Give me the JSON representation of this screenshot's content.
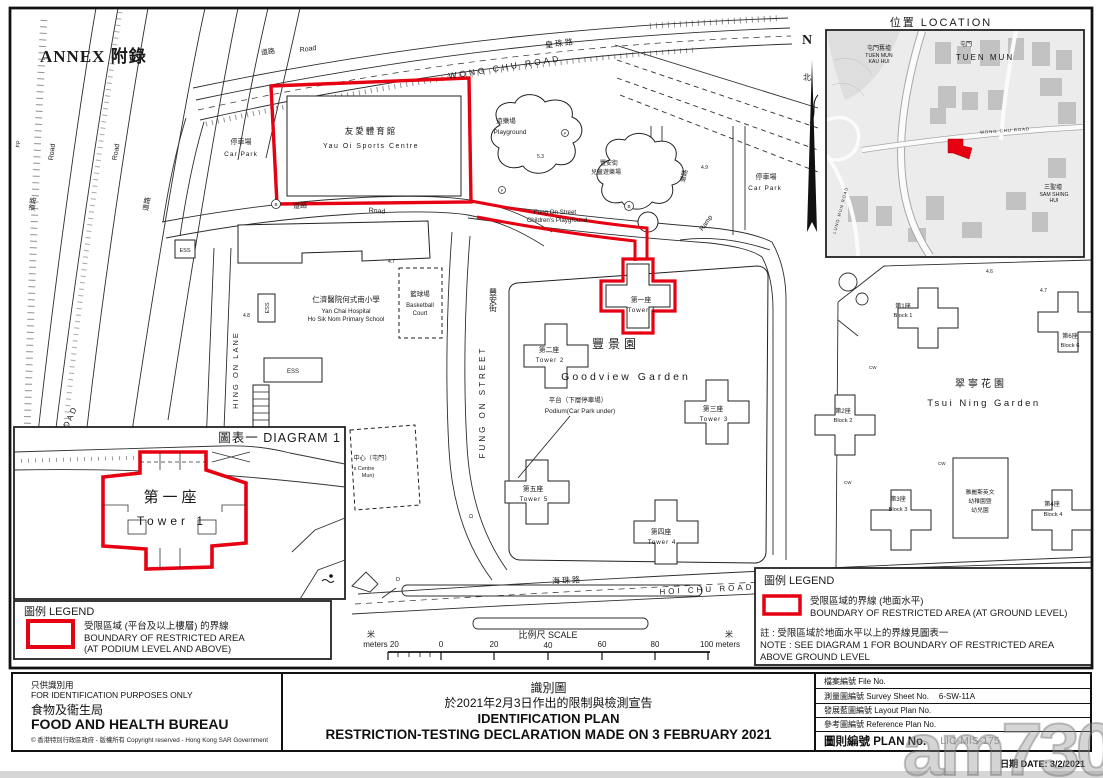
{
  "annex_label": "ANNEX 附錄",
  "watermark_text": "am730",
  "colors": {
    "boundary_red": "#e60012"
  },
  "north_arrow": {
    "n": "N",
    "zh": "北"
  },
  "location_inset": {
    "title": "位置  LOCATION",
    "tuen_mun_kau_hui_zh": "屯門舊墟",
    "tuen_mun_kau_hui_en1": "TUEN MUN",
    "tuen_mun_kau_hui_en2": "KAU HUI",
    "tuen_mun_zh": "屯門",
    "tuen_mun_en": "TUEN MUN",
    "sam_shing_hui_zh": "三聖墟",
    "sam_shing_hui_en1": "SAM SHING",
    "sam_shing_hui_en2": "HUI",
    "wong_chu_road": "WONG CHU ROAD",
    "lung_mun_road": "LUNG MUN ROAD"
  },
  "map": {
    "roads": {
      "wong_chu_zh": "皇珠路",
      "wong_chu_en": "WONG CHU ROAD",
      "hoi_chu_zh": "海珠路",
      "hoi_chu_en": "HOI CHU ROAD",
      "fung_on_zh": "豐安街",
      "fung_on_en": "FUNG ON STREET",
      "hing_on_en": "HING ON LANE",
      "hoi_wong_en": "HOI WONG ROAD",
      "road_zh": "道路",
      "road_en": "Road",
      "ramp": "Ramp"
    },
    "places": {
      "sports_centre_zh": "友愛體育館",
      "sports_centre_en": "Yau Oi Sports Centre",
      "car_park_zh": "停車場",
      "car_park_en": "Car Park",
      "playground_zh": "遊樂場",
      "playground_en": "Playground",
      "fos_pg_zh1": "豐安街",
      "fos_pg_zh2": "兒童遊樂場",
      "fos_pg_en1": "Fung On Street",
      "fos_pg_en2": "Children's Playground",
      "school_zh": "仁濟醫院何式南小學",
      "school_en1": "Yan Chai Hospital",
      "school_en2": "Ho Sik Nom Primary School",
      "basketball_zh": "籃球場",
      "basketball_en1": "Basketball",
      "basketball_en2": "Court",
      "goodview_zh": "豐景園",
      "goodview_en": "Goodview Garden",
      "podium_zh": "平台（下層停車場）",
      "podium_en": "Podium(Car Park under)",
      "tsui_ning_zh": "翠寧花園",
      "tsui_ning_en": "Tsui Ning Garden",
      "kg1": "雅麗斯英文",
      "kg2": "幼稚園暨",
      "kg3": "幼兒園",
      "centre_zh": "中心（屯門）",
      "centre_en1": "s Centre",
      "centre_en2": "Mun)"
    },
    "towers": {
      "t1_zh": "第一座",
      "t1_en": "Tower 1",
      "t2_zh": "第二座",
      "t2_en": "Tower 2",
      "t3_zh": "第三座",
      "t3_en": "Tower 3",
      "t4_zh": "第四座",
      "t4_en": "Tower 4",
      "t5_zh": "第五座",
      "t5_en": "Tower 5"
    },
    "blocks": {
      "b1_zh": "第1座",
      "b1_en": "Block 1",
      "b2_zh": "第2座",
      "b2_en": "Block 2",
      "b3_zh": "第3座",
      "b3_en": "Block 3",
      "b4_zh": "第4座",
      "b4_en": "Block 4",
      "b6_zh": "第6座",
      "b6_en": "Block 6"
    },
    "marks": {
      "cw": "CW",
      "d": "D",
      "b": "B",
      "p": "P",
      "fp": "FP",
      "ess": "ESS"
    },
    "spot_heights": [
      "4.7",
      "4.8",
      "4.9",
      "4.6",
      "4.7",
      "5.3"
    ]
  },
  "diagram1": {
    "title": "圖表一 DIAGRAM 1",
    "tower_zh": "第一座",
    "tower_en": "Tower 1"
  },
  "legend_podium": {
    "title": "圖例 LEGEND",
    "line_zh": "受限區域 (平台及以上樓層) 的界線",
    "line_en1": "BOUNDARY OF RESTRICTED AREA",
    "line_en2": "(AT PODIUM LEVEL AND ABOVE)"
  },
  "legend_ground": {
    "title": "圖例 LEGEND",
    "line_zh": "受限區域的界線 (地面水平)",
    "line_en": "BOUNDARY OF RESTRICTED AREA (AT GROUND LEVEL)",
    "note_zh": "註 : 受限區域於地面水平以上的界線見圖表一",
    "note_en1": "NOTE : SEE DIAGRAM 1 FOR BOUNDARY OF RESTRICTED AREA",
    "note_en2": "ABOVE GROUND LEVEL"
  },
  "scale_bar": {
    "unit_zh": "米",
    "left_label": "meters 20",
    "title": "比例尺  SCALE",
    "ticks": [
      "0",
      "20",
      "40",
      "60",
      "80"
    ],
    "right_label": "100 meters"
  },
  "title_block": {
    "left": {
      "purpose_zh": "只供識別用",
      "purpose_en": "FOR IDENTIFICATION PURPOSES ONLY",
      "bureau_zh": "食物及衞生局",
      "bureau_en": "FOOD AND HEALTH BUREAU",
      "copyright": "© 香港特別行政區政府 - 版權所有 Copyright reserved - Hong Kong SAR Government"
    },
    "center": {
      "line1": "識別圖",
      "line2": "於2021年2月3日作出的限制與檢測宣告",
      "line3": "IDENTIFICATION PLAN",
      "line4": "RESTRICTION-TESTING DECLARATION MADE ON 3 FEBRUARY 2021"
    },
    "right": {
      "rows": [
        {
          "label": "檔案編號  File  No.",
          "value": ""
        },
        {
          "label": "測量圖編號  Survey  Sheet  No.",
          "value": "6-SW-11A"
        },
        {
          "label": "發展藍圖編號  Layout  Plan  No.",
          "value": ""
        },
        {
          "label": "參考圖編號  Reference  Plan  No.",
          "value": ""
        },
        {
          "label": "圖則編號  PLAN  No.",
          "value": "LIC-MIS-175"
        }
      ],
      "date": "日期    DATE: 3/2/2021"
    }
  }
}
